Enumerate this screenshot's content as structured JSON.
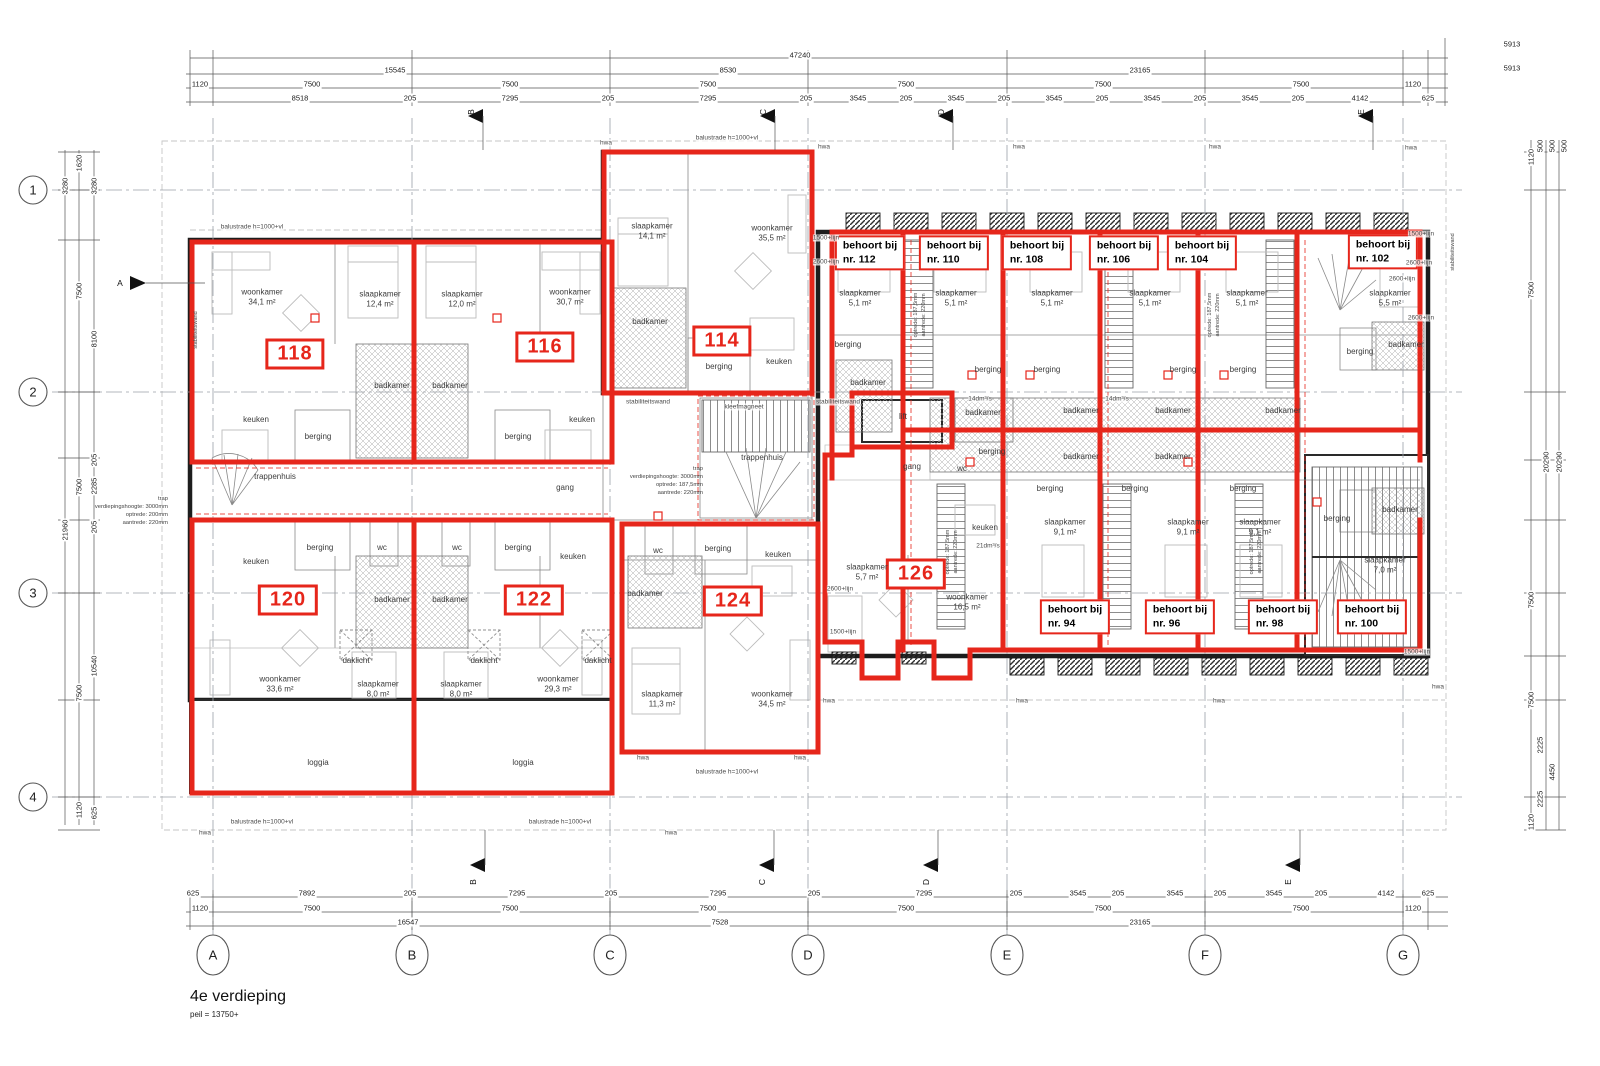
{
  "colors": {
    "red": "#e6261b",
    "wall": "#1d1d1d",
    "hatch": "#adadad"
  },
  "title_block": {
    "name": "4e verdieping",
    "level": "peil = 13750+"
  },
  "grid": {
    "rows": [
      "1",
      "2",
      "3",
      "4"
    ],
    "cols": [
      "A",
      "B",
      "C",
      "D",
      "E",
      "F",
      "G"
    ]
  },
  "flags": {
    "left": "A",
    "top": [
      "B",
      "C",
      "D",
      "E"
    ],
    "bottom": [
      "B",
      "C",
      "D",
      "E"
    ]
  },
  "unit_numbers": [
    "118",
    "116",
    "114",
    "120",
    "122",
    "124",
    "126"
  ],
  "behoort": [
    {
      "l1": "behoort bij",
      "l2": "nr. 112"
    },
    {
      "l1": "behoort bij",
      "l2": "nr. 110"
    },
    {
      "l1": "behoort bij",
      "l2": "nr. 108"
    },
    {
      "l1": "behoort bij",
      "l2": "nr. 106"
    },
    {
      "l1": "behoort bij",
      "l2": "nr. 104"
    },
    {
      "l1": "behoort bij",
      "l2": "nr. 102"
    },
    {
      "l1": "behoort bij",
      "l2": "nr. 94"
    },
    {
      "l1": "behoort bij",
      "l2": "nr. 96"
    },
    {
      "l1": "behoort bij",
      "l2": "nr. 98"
    },
    {
      "l1": "behoort bij",
      "l2": "nr. 100"
    }
  ],
  "rooms": [
    {
      "n": "woonkamer",
      "a": "34,1 m²"
    },
    {
      "n": "slaapkamer",
      "a": "12,4 m²"
    },
    {
      "n": "slaapkamer",
      "a": "12,0 m²"
    },
    {
      "n": "woonkamer",
      "a": "30,7 m²"
    },
    {
      "n": "keuken"
    },
    {
      "n": "badkamer"
    },
    {
      "n": "badkamer"
    },
    {
      "n": "berging"
    },
    {
      "n": "berging"
    },
    {
      "n": "keuken"
    },
    {
      "n": "trappenhuis"
    },
    {
      "n": "gang"
    },
    {
      "n": "slaapkamer",
      "a": "14,1 m²"
    },
    {
      "n": "woonkamer",
      "a": "35,5 m²"
    },
    {
      "n": "badkamer"
    },
    {
      "n": "berging"
    },
    {
      "n": "keuken"
    },
    {
      "n": "trappenhuis"
    },
    {
      "n": "keuken"
    },
    {
      "n": "berging"
    },
    {
      "n": "wc"
    },
    {
      "n": "wc"
    },
    {
      "n": "berging"
    },
    {
      "n": "keuken"
    },
    {
      "n": "badkamer"
    },
    {
      "n": "badkamer"
    },
    {
      "n": "woonkamer",
      "a": "33,6 m²"
    },
    {
      "n": "slaapkamer",
      "a": "8,0 m²"
    },
    {
      "n": "slaapkamer",
      "a": "8,0 m²"
    },
    {
      "n": "woonkamer",
      "a": "29,3 m²"
    },
    {
      "n": "daklicht"
    },
    {
      "n": "daklicht"
    },
    {
      "n": "daklicht"
    },
    {
      "n": "loggia"
    },
    {
      "n": "loggia"
    },
    {
      "n": "wc"
    },
    {
      "n": "berging"
    },
    {
      "n": "keuken"
    },
    {
      "n": "badkamer"
    },
    {
      "n": "slaapkamer",
      "a": "11,3 m²"
    },
    {
      "n": "woonkamer",
      "a": "34,5 m²"
    },
    {
      "n": "lift"
    },
    {
      "n": "gang"
    },
    {
      "n": "wc"
    },
    {
      "n": "berging"
    },
    {
      "n": "keuken"
    },
    {
      "n": "slaapkamer",
      "a": "5,7 m²"
    },
    {
      "n": "woonkamer",
      "a": "16,5 m²"
    },
    {
      "n": "slaapkamer",
      "a": "5,1 m²"
    },
    {
      "n": "slaapkamer",
      "a": "5,1 m²"
    },
    {
      "n": "slaapkamer",
      "a": "5,1 m²"
    },
    {
      "n": "slaapkamer",
      "a": "5,1 m²"
    },
    {
      "n": "slaapkamer",
      "a": "5,1 m²"
    },
    {
      "n": "slaapkamer",
      "a": "5,5 m²"
    },
    {
      "n": "berging"
    },
    {
      "n": "badkamer"
    },
    {
      "n": "badkamer"
    },
    {
      "n": "badkamer"
    },
    {
      "n": "badkamer"
    },
    {
      "n": "badkamer"
    },
    {
      "n": "badkamer"
    },
    {
      "n": "badkamer"
    },
    {
      "n": "berging"
    },
    {
      "n": "berging"
    },
    {
      "n": "berging"
    },
    {
      "n": "berging"
    },
    {
      "n": "berging"
    },
    {
      "n": "berging"
    },
    {
      "n": "berging"
    },
    {
      "n": "slaapkamer",
      "a": "9,1 m²"
    },
    {
      "n": "slaapkamer",
      "a": "9,1 m²"
    },
    {
      "n": "slaapkamer",
      "a": "9,1 m²"
    },
    {
      "n": "slaapkamer",
      "a": "7,0 m²"
    },
    {
      "n": "berging"
    },
    {
      "n": "badkamer"
    },
    {
      "n": "berging"
    },
    {
      "n": "badkamer"
    }
  ],
  "ann": [
    "hwa",
    "hwa",
    "hwa",
    "hwa",
    "hwa",
    "hwa",
    "hwa",
    "hwa",
    "hwa",
    "hwa",
    "hwa",
    "hwa",
    "hwa",
    "2600+lijn",
    "2600+lijn",
    "2600+lijn",
    "2600+lijn",
    "2600+lijn",
    "1500+lijn",
    "1500+lijn",
    "1500+lijn",
    "1500+lijn",
    "balustrade h=1000+vl",
    "balustrade h=1000+vl",
    "balustrade h=1000+vl",
    "balustrade h=1000+vl",
    "balustrade h=1000+vl",
    "stabiliteitswand",
    "stabiliteitswand",
    "stabiliteitswand",
    "stabiliteitswand",
    "kleefmagneet",
    "14dm³/s",
    "14dm³/s",
    "21dm³/s",
    "optrede: 187,5mm",
    "aantrede: 220mm",
    "optrede: 187,5mm",
    "aantrede: 220mm",
    "optrede: 187,5mm",
    "aantrede: 220mm",
    "optrede: 187,5mm",
    "aantrede: 220mm",
    "trap\nverdiepingshoogte: 3000mm\noptrede: 200mm\naantrede: 220mm",
    "trap\nverdiepingshoogte: 3000mm\noptrede: 187,5mm\naantrede: 220mm"
  ],
  "dims": {
    "t0": [
      "47240",
      "5913"
    ],
    "t1": [
      "15545",
      "8530",
      "23165",
      "5913"
    ],
    "t2": [
      "1120",
      "7500",
      "7500",
      "7500",
      "7500",
      "7500",
      "7500",
      "1120"
    ],
    "t3": [
      "8518",
      "205",
      "7295",
      "205",
      "7295",
      "205",
      "3545",
      "205",
      "3545",
      "205",
      "3545",
      "205",
      "3545",
      "205",
      "3545",
      "205",
      "4142",
      "625"
    ],
    "b1": [
      "625",
      "7892",
      "205",
      "7295",
      "205",
      "7295",
      "205",
      "7295",
      "205",
      "3545",
      "205",
      "3545",
      "205",
      "3545",
      "205",
      "4142",
      "625"
    ],
    "b2": [
      "1120",
      "7500",
      "7500",
      "7500",
      "7500",
      "7500",
      "7500",
      "1120"
    ],
    "b3": [
      "16547",
      "7528",
      "23165"
    ],
    "l": [
      "1620",
      "3280",
      "3280",
      "7500",
      "8100",
      "7500",
      "205",
      "2285",
      "205",
      "21960",
      "10540",
      "7500",
      "1120",
      "625"
    ],
    "r": [
      "1120",
      "500",
      "500",
      "500",
      "7500",
      "20290",
      "20290",
      "7500",
      "7500",
      "2225",
      "4450",
      "2225",
      "1120"
    ]
  }
}
